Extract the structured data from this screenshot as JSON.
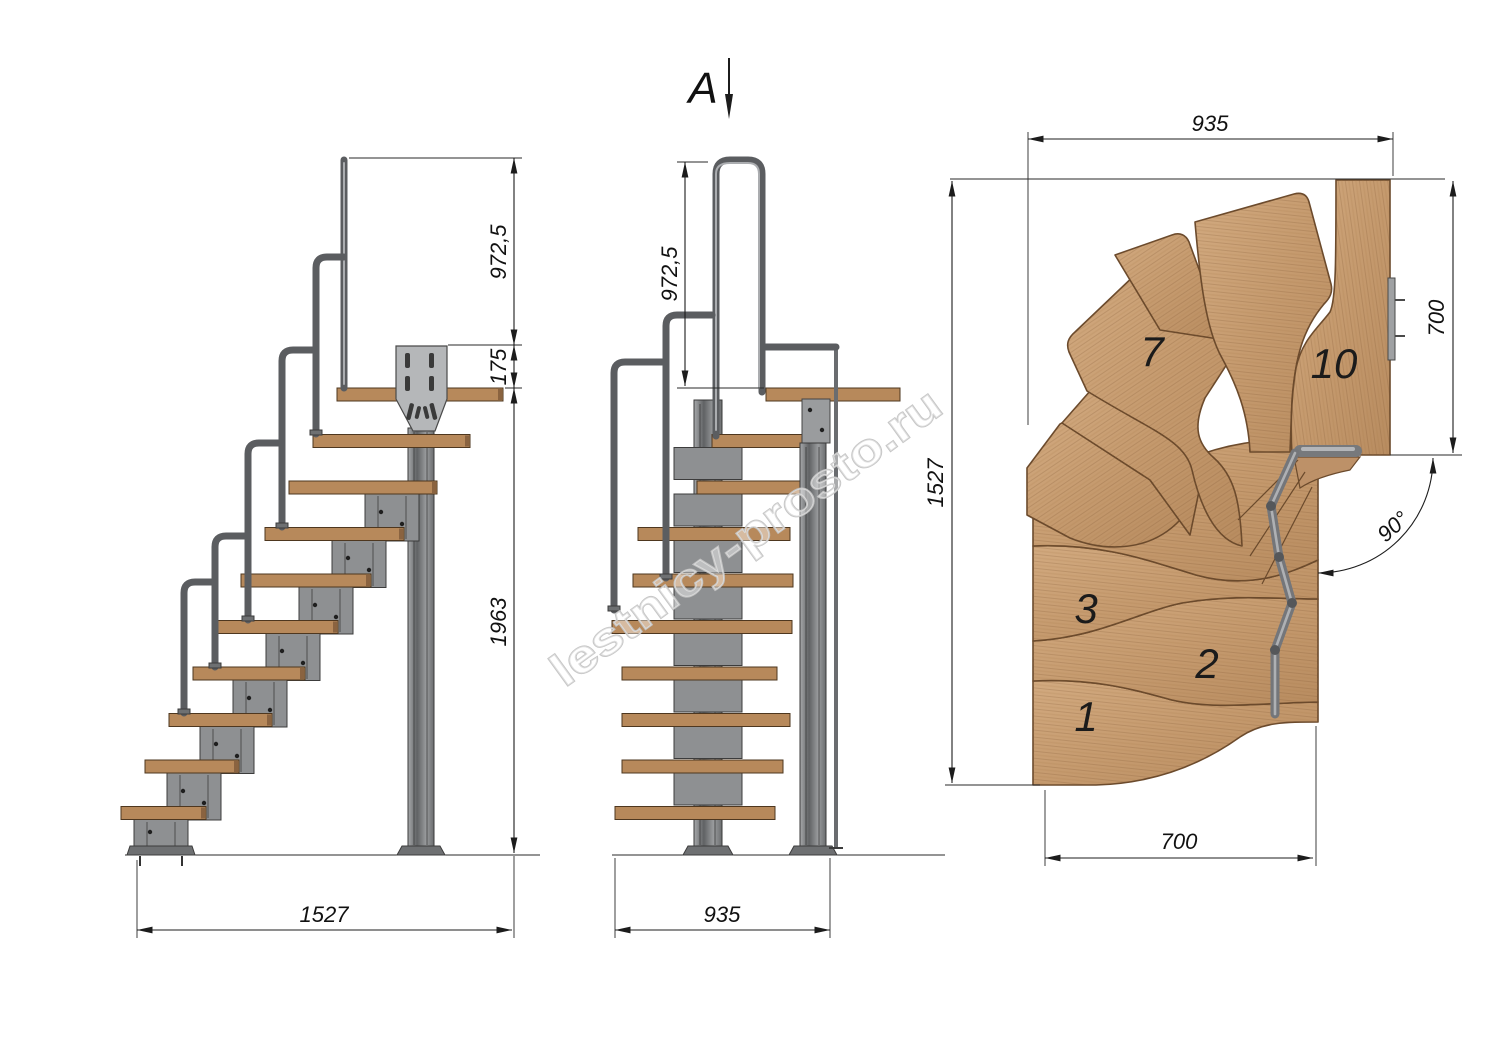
{
  "marker": {
    "label": "A"
  },
  "watermark": {
    "text": "lestnicy-prosto.ru"
  },
  "side_view": {
    "dim_rail_height": "972,5",
    "dim_riser": "175",
    "dim_total_height": "1963",
    "dim_length": "1527"
  },
  "front_view": {
    "dim_rail_height": "972,5",
    "dim_width": "935"
  },
  "plan_view": {
    "dim_width_top": "935",
    "dim_depth_left": "1527",
    "dim_exit_right": "700",
    "dim_width_bottom": "700",
    "dim_turn_angle": "90°",
    "steps": {
      "s1": "1",
      "s2": "2",
      "s3": "3",
      "s7": "7",
      "s10": "10"
    }
  },
  "colors": {
    "wood_light": "#cfa67c",
    "wood_dark": "#ad8055",
    "metal": "#8f9194",
    "metal_dark": "#5c5e60",
    "line": "#1c1c1c"
  }
}
